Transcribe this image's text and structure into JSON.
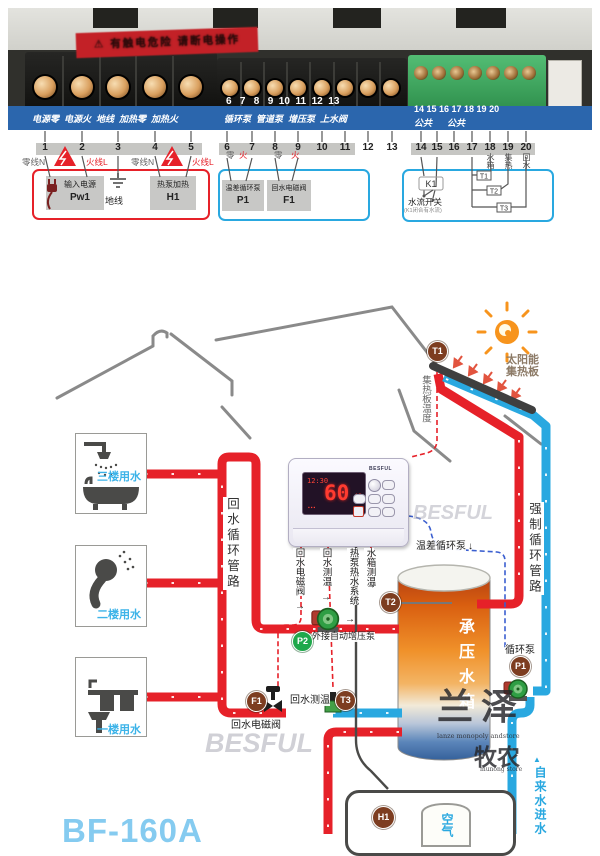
{
  "terminal_photo": {
    "warning_sticker": "⚠ 有触电危险 请断电操作",
    "pcb_power_labels": "电源零  电源火  地线  加热零  加热火",
    "pcb_mid_numbers": "6   7   8   9  10  11  12  13",
    "pcb_mid_labels": "循环泵  管道泵  增压泵  上水阀",
    "pcb_right_numbers": "14 15 16 17 18 19 20",
    "pcb_right_labels": "公共      公共"
  },
  "legend": {
    "terminals": [
      "1",
      "2",
      "3",
      "4",
      "5",
      "6",
      "7",
      "8",
      "9",
      "10",
      "11",
      "12",
      "13",
      "14",
      "15",
      "16",
      "17",
      "18",
      "19",
      "20"
    ],
    "neutral1": "零线N",
    "live1": "火线L",
    "neutral2": "零线N",
    "live2": "火线L",
    "zero6": "零",
    "fire7": "火",
    "zero8": "零",
    "fire9": "火",
    "power_group": {
      "input_label": "输入电源",
      "input_code": "Pw1",
      "ground_label": "地线",
      "heater_label": "热泵加热",
      "heater_code": "H1"
    },
    "output_group": {
      "pump_label": "温差循环泵",
      "pump_code": "P1",
      "valve_label": "回水电磁阀",
      "valve_code": "F1"
    },
    "sensor_group": {
      "k1": "K1",
      "flow_switch": "水流开关",
      "flow_note": "(K1闭合有水流)",
      "t1": "T1",
      "t2": "T2",
      "t3": "T3",
      "tank_v": "水箱",
      "collector_v": "集热",
      "return_v": "回水"
    }
  },
  "diagram": {
    "floors": {
      "f3": "三楼用水",
      "f2": "二楼用水",
      "f1": "一楼用水"
    },
    "labels": {
      "return_loop": "回水循环管路",
      "forced_loop": "强制循环管路",
      "tap_water": "自来水进水",
      "tap_arrow": "▲",
      "collector_temp": "集热板温度",
      "solar1": "太阳能",
      "solar2": "集热板",
      "diff_pump": "温差循环泵",
      "diff_pump_arrow": "↓",
      "p1_pump": "循环泵",
      "p2_pump": "外接自动增压泵",
      "t3_sensor": "回水测温",
      "f1_valve": "回水电磁阀",
      "out1": "回水电磁阀",
      "out2": "回水测温",
      "out3": "热泵热水系统",
      "out4": "水箱测温",
      "arrow_right": "→"
    },
    "controller": {
      "brand": "BESFUL",
      "time": "12:30",
      "temp": "60",
      "unit": "℃",
      "dots": "▪▪▪"
    },
    "tank_label": "承压水箱",
    "heat_pump_label": "空气",
    "badges": {
      "t1": "T1",
      "t2": "T2",
      "t3": "T3",
      "p1": "P1",
      "p2": "P2",
      "f1": "F1",
      "h1": "H1"
    },
    "model": "BF-160A",
    "watermarks": {
      "besful1": "BESFUL",
      "besful2": "BESFUL",
      "lanze": "兰泽",
      "lanze_sub": "lanze monopoly andstore",
      "munong": "牧农",
      "munong_sub": "munong store"
    }
  }
}
